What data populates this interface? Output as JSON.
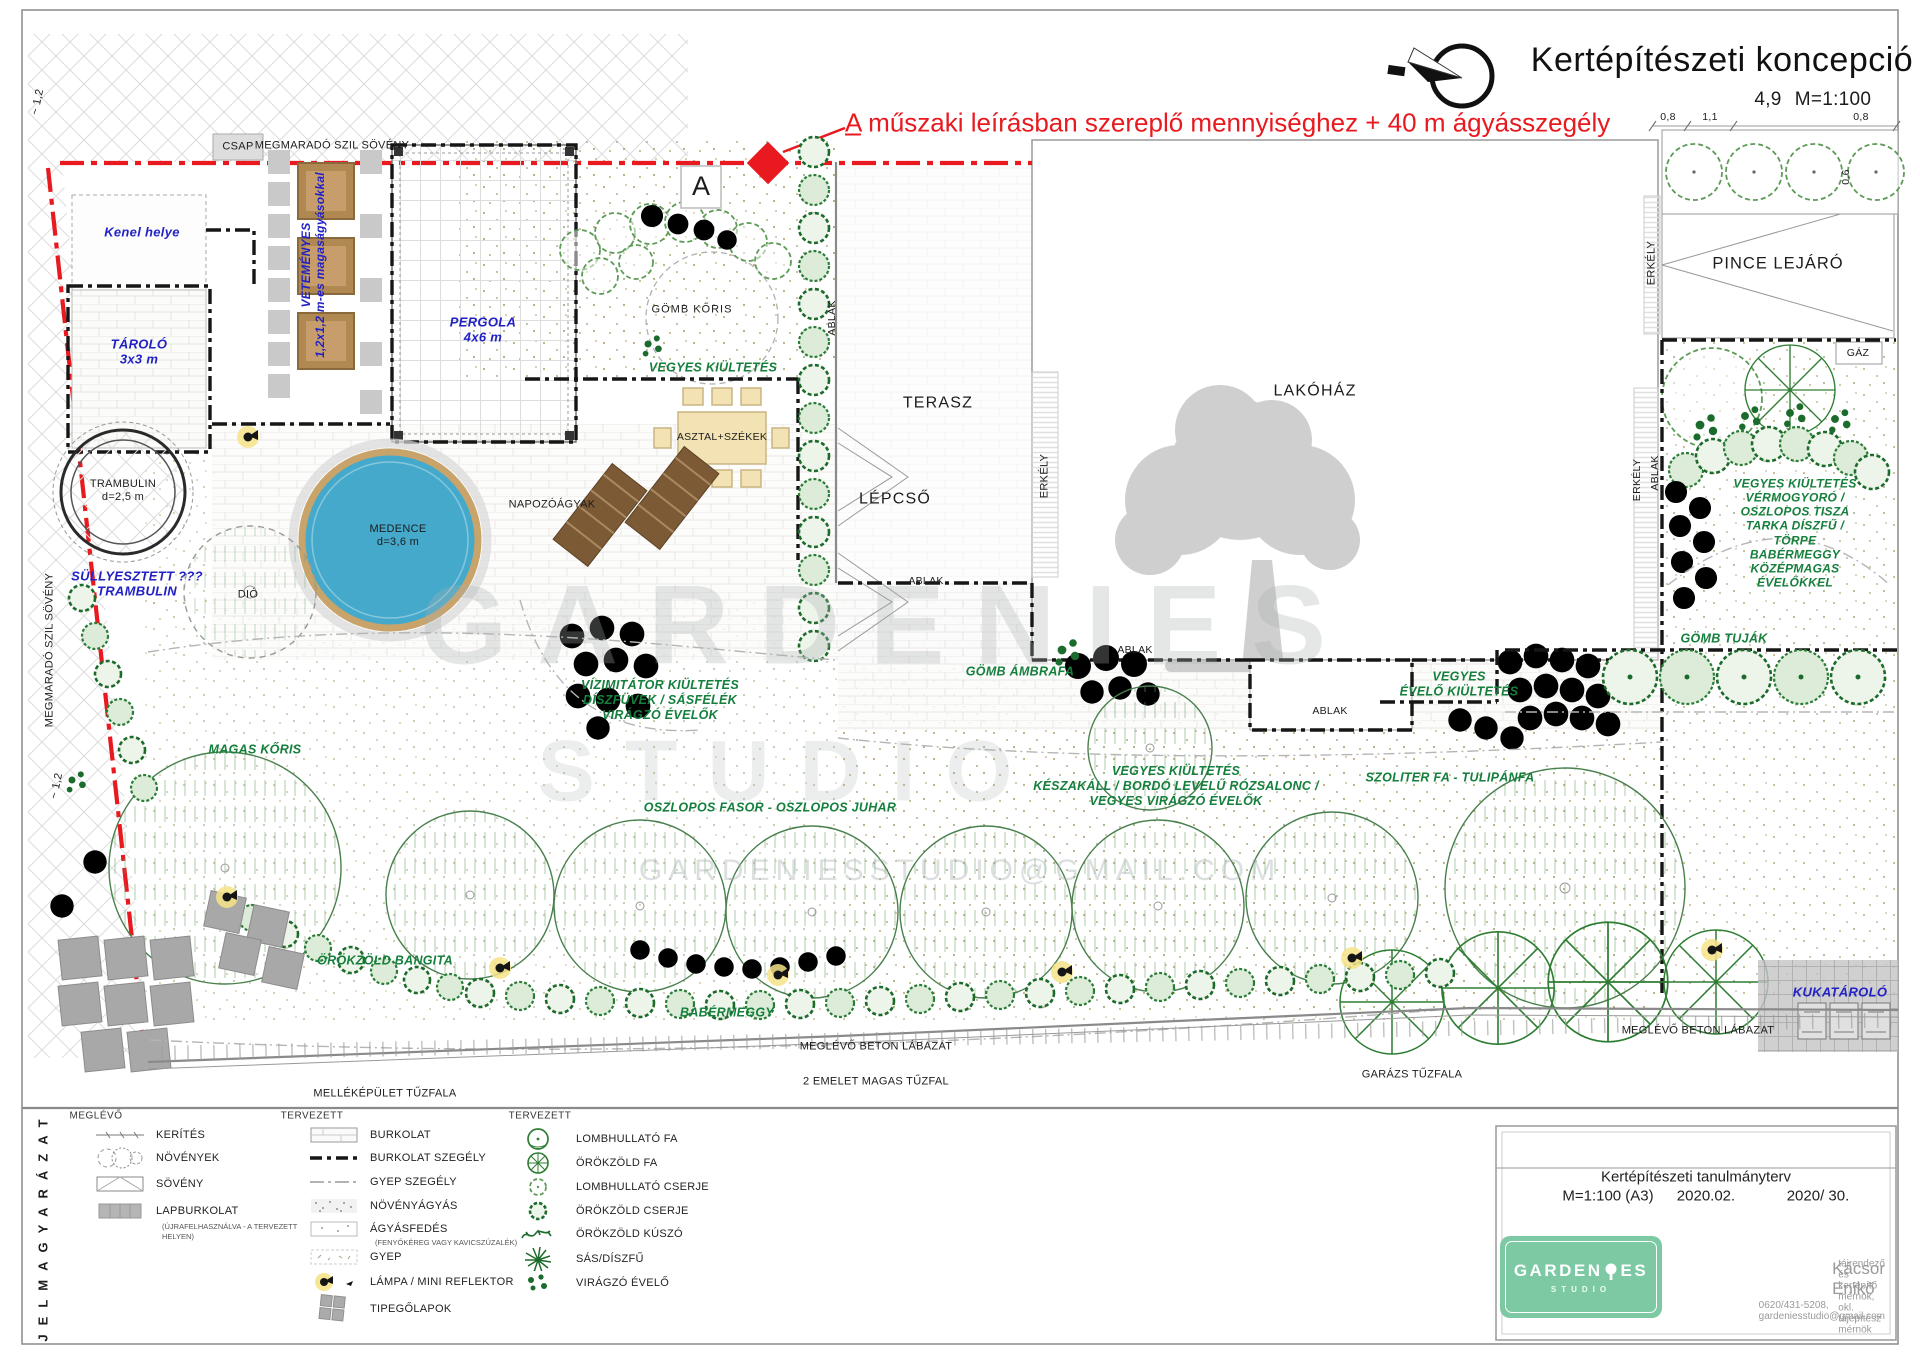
{
  "header": {
    "title": "Kertépítészeti koncepció",
    "scale_prefix": "4,9",
    "scale": "M=1:100",
    "red_marker": "A",
    "red_note": "műszaki leírásban szereplő mennyiséghez + 40 m ágyásszegély",
    "dim_left": "0,8",
    "dim_mid": "1,1",
    "dim_right": "0,8",
    "dim_vert": "0,6"
  },
  "plan": {
    "megmarado_top": "MEGMARADÓ SZIL SÖVÉNY",
    "megmarado_left": "MEGMARADÓ SZIL SÖVÉNY",
    "dim_12a": "~ 1,2",
    "dim_12b": "~ 1,2",
    "csap": "CSAP",
    "kenel": "Kenel helye",
    "tarolo": "TÁROLÓ\n3x3 m",
    "vetemenyes": "VETEMÉNYES\n1,2x1,2 m-es magaságyásokkal",
    "pergola": "PERGOLA\n4x6 m",
    "a_marker": "A",
    "gomb_koris": "GÖMB KŐRIS",
    "vegyes_kiultetes": "VEGYES KIÜLTETÉS",
    "asztal_szekek": "ASZTAL+SZÉKEK",
    "napozoagyak": "NAPOZÓÁGYAK",
    "medence": "MEDENCE\nd=3,6 m",
    "trambulin": "TRAMBULIN\nd=2,5 m",
    "sullyesztett": "SÜLLYESZTETT ???\nTRAMBULIN",
    "dio": "DIÓ",
    "terasz": "TERASZ",
    "lepcso": "LÉPCSŐ",
    "lakohaz": "LAKÓHÁZ",
    "ablak": "ABLAK",
    "erkely": "ERKÉLY",
    "pince_lejaro": "PINCE LEJÁRÓ",
    "gaz": "GÁZ",
    "vegyes_jobb": "VEGYES KIÜLTETÉS\nVÉRMOGYORÓ / OSZLOPOS TISZA\nTARKA DÍSZFŰ / TÖRPE BABÉRMEGGY\nKÖZÉPMAGAS ÉVELŐKKEL",
    "vizimitator": "VÍZIMITÁTOR KIÜLTETÉS\nDÍSZFÜVEK / SÁSFÉLÉK\nVIRÁGZÓ ÉVELŐK",
    "gomb_ambrafa": "GÖMB ÁMBRAFA",
    "vegyes_evelo": "VEGYES\nÉVELŐ KIÜLTETÉS",
    "gomb_tujak": "GÖMB TUJÁK",
    "magas_koris": "MAGAS KŐRIS",
    "oszlopos_fasor": "OSZLOPOS FASOR - OSZLOPOS JUHAR",
    "vegyes_kozep": "VEGYES KIÜLTETÉS\nKÉSZAKÁLL / BORDÓ LEVELŰ RÓZSALONC /\nVEGYES VIRÁGZÓ ÉVELŐK",
    "szoliter": "SZOLITER FA - TULIPÁNFA",
    "orokzold_bangita": "ÖRÖKZÖLD BANGITA",
    "babermeggy": "BABÉRMEGGY",
    "beton_labazat": "MEGLÉVŐ BETON LÁBAZAT",
    "emelet_tuzfal": "2 EMELET MAGAS TŰZFAL",
    "mellekepulet_tuzfal": "MELLÉKÉPÜLET TŰZFALA",
    "garazs_tuzfal": "GARÁZS TŰZFALA",
    "kukatarolo": "KUKATÁROLÓ"
  },
  "legend": {
    "side_label": "JELMAGYARÁZAT",
    "col1": {
      "header": "MEGLÉVŐ",
      "items": [
        "KERÍTÉS",
        "NÖVÉNYEK",
        "SÖVÉNY",
        "LAPBURKOLAT"
      ],
      "lapburkolat_sub": "(ÚJRAFELHASZNÁLVA - A TERVEZETT\nHELYEN)"
    },
    "col2": {
      "header": "TERVEZETT",
      "items": [
        "BURKOLAT",
        "BURKOLAT SZEGÉLY",
        "GYEP SZEGÉLY",
        "NÖVÉNYÁGYÁS",
        "ÁGYÁSFEDÉS",
        "GYEP",
        "LÁMPA / MINI REFLEKTOR",
        "TIPEGŐLAPOK"
      ],
      "agyasfedes_sub": "(FENYŐKÉREG VAGY KAVICSZÚZALÉK)"
    },
    "col3": {
      "header": "TERVEZETT",
      "items": [
        "LOMBHULLATÓ FA",
        "ÖRÖKZÖLD FA",
        "LOMBHULLATÓ CSERJE",
        "ÖRÖKZÖLD CSERJE",
        "ÖRÖKZÖLD KÚSZÓ",
        "SÁS/DÍSZFŰ",
        "VIRÁGZÓ ÉVELŐ"
      ]
    }
  },
  "titleblock": {
    "project_title": "Kertépítészeti tanulmányterv",
    "scale": "M=1:100 (A3)",
    "date": "2020.02.",
    "sheet": "2020/ 30.",
    "logo_left": "GARDEN",
    "logo_right": "ES",
    "logo_sub": "STUDIO",
    "designer": "Kácsor Enikő",
    "credentials": "tájrendező és kertépítő mérnök, okl. tájépítész mérnök",
    "contact": "0620/431-5208, gardeniesstudio@gmail.com"
  },
  "watermark": {
    "brand": "GARDENIES",
    "studio": "STUDIO",
    "email": "GARDENIESSTUDIO@GMAIL.COM"
  },
  "colors": {
    "red": "#e8191f",
    "blue": "#2222c4",
    "green_label": "#157f3d",
    "pool": "#45a9cb",
    "logo_green": "#7cc9a4"
  }
}
